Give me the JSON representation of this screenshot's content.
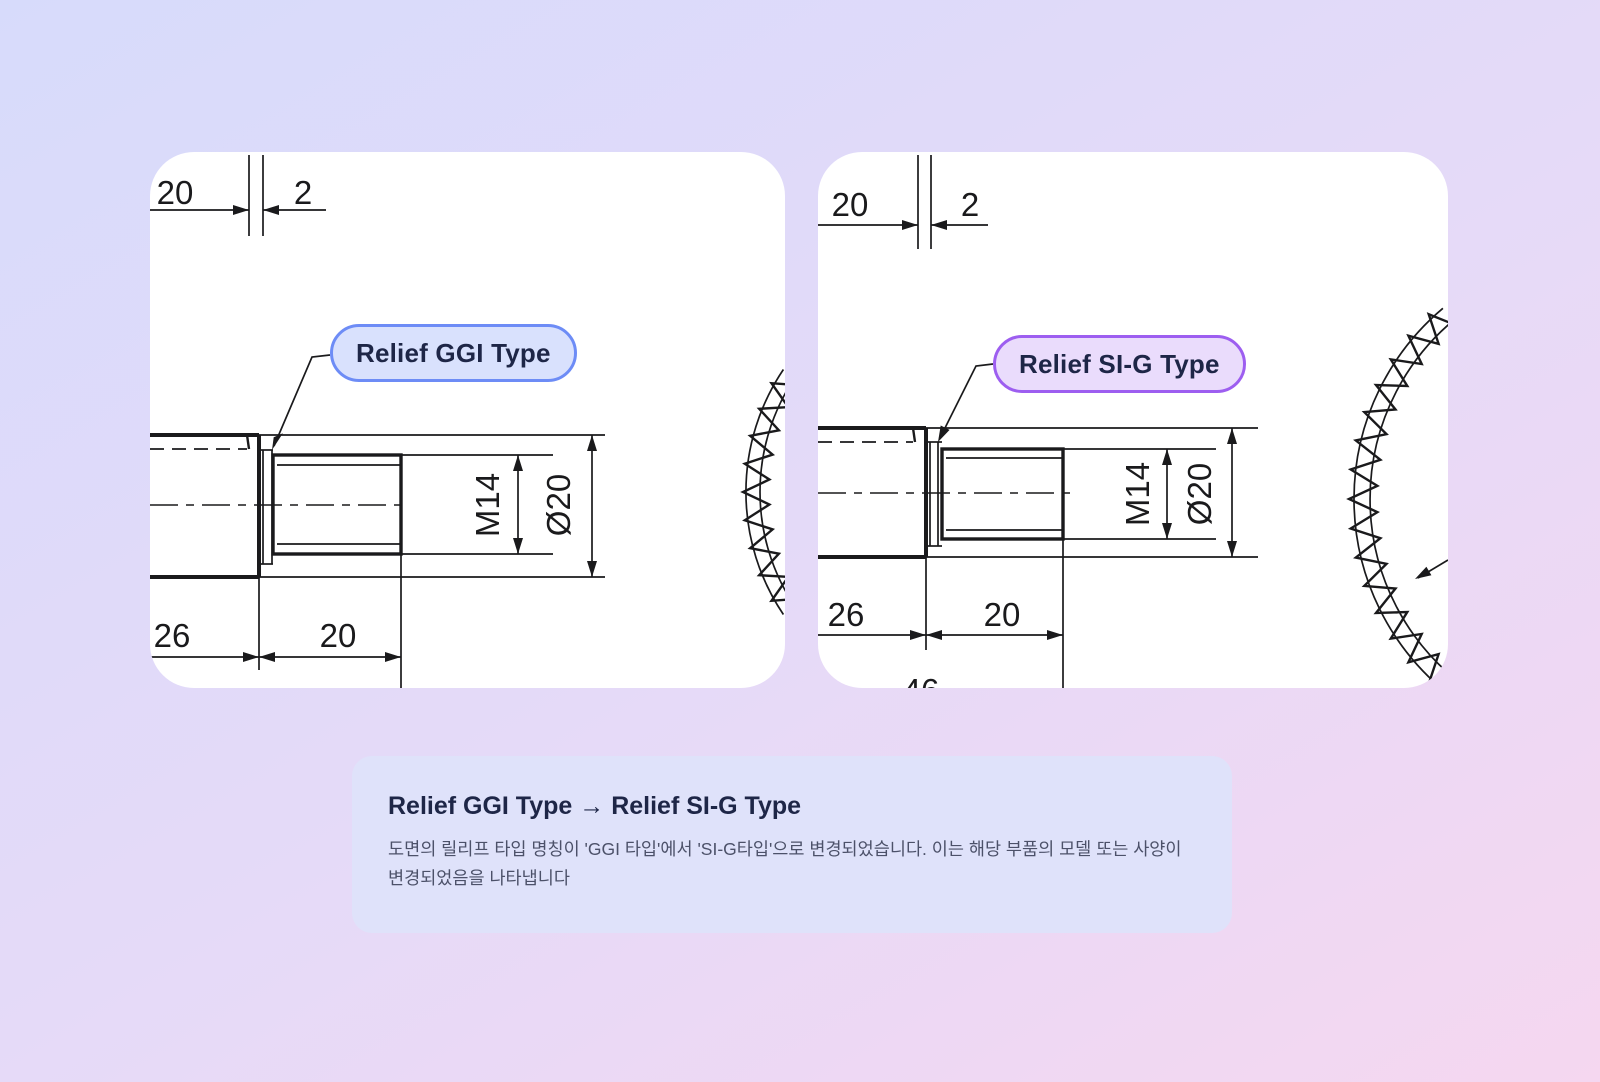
{
  "colors": {
    "accent-blue": "#6d8cf6",
    "pill-blue-bg": "#d9e1fd",
    "accent-purple": "#9d5ef0",
    "pill-purple-bg": "#eadcfc",
    "card-bg": "#dfe2fa",
    "panel-bg": "#ffffff",
    "ink": "#1e2647",
    "body-text": "#4c5169",
    "line": "#1a1a1c",
    "bg-start": "#d7dbfb",
    "bg-mid": "#e5daf8",
    "bg-end": "#f5d7f0"
  },
  "left_panel": {
    "label": "Relief GGI Type",
    "dim_top_a": "20",
    "dim_top_b": "2",
    "thread": "M14",
    "diameter": "Ø20",
    "dim_len_a": "26",
    "dim_len_b": "20"
  },
  "right_panel": {
    "label": "Relief SI-G Type",
    "dim_top_a": "20",
    "dim_top_b": "2",
    "thread": "M14",
    "diameter": "Ø20",
    "dim_len_a": "26",
    "dim_len_b": "20",
    "dim_clipped": "46"
  },
  "note_card": {
    "title": "Relief GGI Type → Relief SI-G Type",
    "body": "도면의 릴리프 타입 명칭이 'GGI 타입'에서 'SI-G타입'으로 변경되었습니다. 이는 해당 부품의 모델 또는 사양이 변경되었음을 나타냅니다"
  }
}
